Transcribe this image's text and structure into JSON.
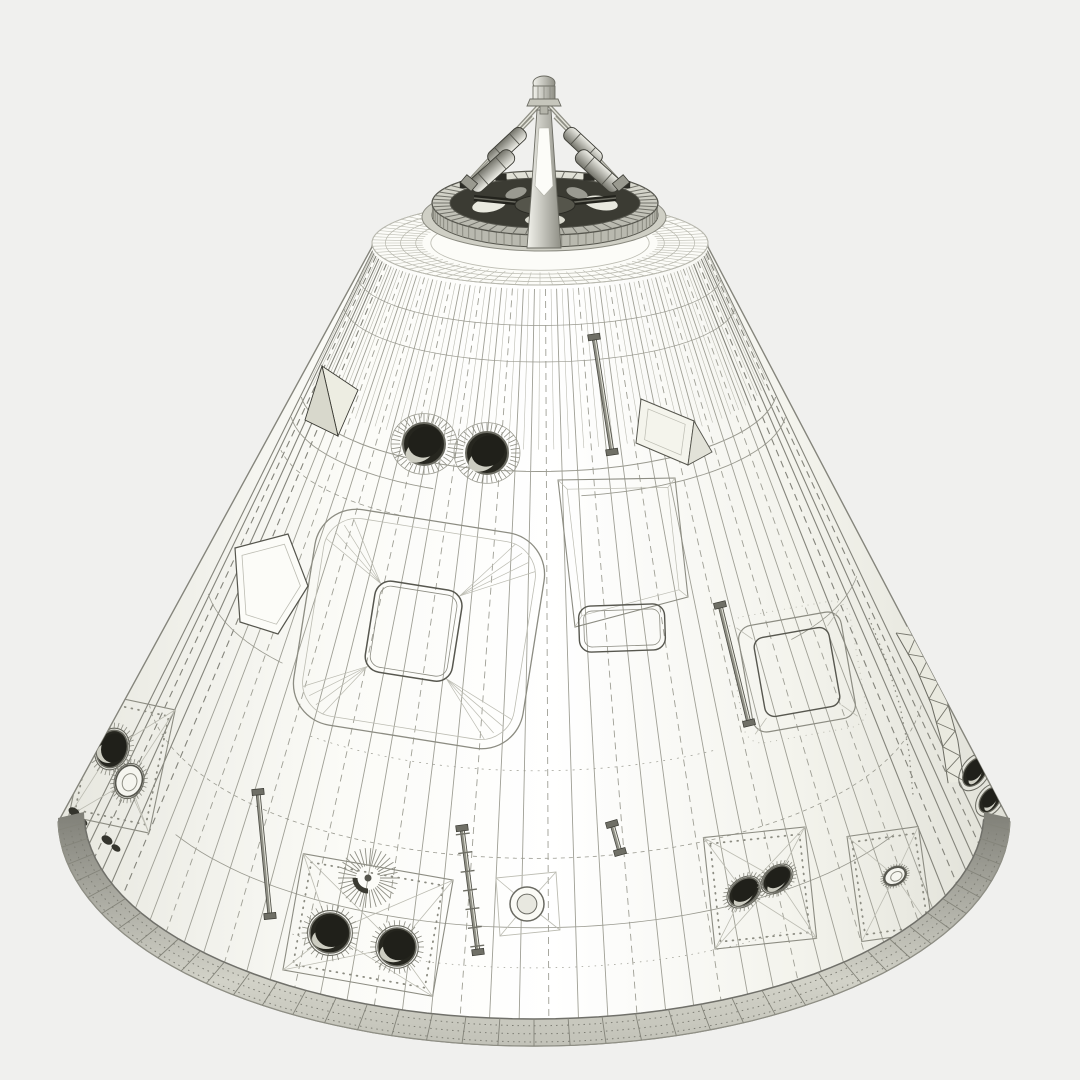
{
  "meta": {
    "alt": "Monochrome 3D wireframe render of an Apollo-style command module space capsule: truncated cone with docking probe and ring on top, crew hatch, portholes, windows, handrails, riveted RCS thruster panels and a shaded aft heat-shield rim."
  },
  "palette": {
    "background": "#f0f0ee",
    "coneEdge": "#85857c",
    "line": "#9f9f95",
    "lineDark": "#6b6b62",
    "lineFaint": "#bcbcb2",
    "ink": "#3a3a33",
    "dark": "#26261f",
    "panelStroke": "#8c8c82",
    "rivet": "#8c8c82",
    "metalDark": "#44443c",
    "ringInterior": "#3b3b33",
    "crescent": "#cdcdc2",
    "white": "#fcfcf8",
    "coneGrad": [
      "#e7e7df",
      "#fbfbf7",
      "#ffffff",
      "#f3f3ec",
      "#e0e0d7"
    ],
    "rimGrad": [
      "#7f7f77",
      "#a9a9a0",
      "#d2d2c8",
      "#c2c2b8"
    ],
    "shaftGrad": [
      "#f2f2ec",
      "#8f8f85"
    ],
    "cylGrad": [
      "#efefe8",
      "#73736a"
    ],
    "ringTopGrad": [
      "#e5e5db",
      "#b1b1a7"
    ]
  },
  "render": {
    "canvas": {
      "w": 1080,
      "h": 1080
    },
    "cone": {
      "top": {
        "cx": 540,
        "cy": 247,
        "rx": 168,
        "ry": 42
      },
      "baseOuter": {
        "cx": 534,
        "cy": 818,
        "rx": 476,
        "ry": 228
      },
      "baseInner": {
        "cx": 534,
        "cy": 812,
        "rx": 450,
        "ry": 207
      },
      "meridians": {
        "n": 46,
        "a0": 5,
        "a1": 175
      },
      "subMeridians": {
        "n": 45,
        "fEnd": 0.22
      },
      "latitudes": [
        {
          "f": 0.05,
          "a0": 5,
          "a1": 175,
          "w": 0.7
        },
        {
          "f": 0.1,
          "a0": 5,
          "a1": 175,
          "w": 0.7
        },
        {
          "f": 0.25,
          "a0": 6,
          "a1": 174,
          "w": 1.0
        },
        {
          "f": 0.285,
          "a0": 6,
          "a1": 80,
          "w": 0.9
        },
        {
          "f": 0.285,
          "a0": 115,
          "a1": 174,
          "w": 0.9
        },
        {
          "f": 0.33,
          "a0": 120,
          "a1": 170,
          "w": 0.8,
          "dash": "5 4"
        },
        {
          "f": 0.55,
          "a0": 8,
          "a1": 38,
          "w": 0.8
        },
        {
          "f": 0.58,
          "a0": 140,
          "a1": 172,
          "w": 0.8
        },
        {
          "f": 0.66,
          "a0": 60,
          "a1": 130,
          "w": 0.7,
          "dash": "2 5"
        },
        {
          "f": 0.78,
          "a0": 6,
          "a1": 174,
          "w": 0.8,
          "dash": "4 4"
        },
        {
          "f": 0.875,
          "a0": 30,
          "a1": 150,
          "w": 0.8
        },
        {
          "f": 0.93,
          "a0": 55,
          "a1": 125,
          "w": 0.7,
          "dash": "1.5 5"
        }
      ]
    },
    "dome": {
      "cx": 540,
      "cy": 243,
      "rx": 168,
      "ry": 42,
      "rings": [
        1,
        0.92,
        0.83,
        0.74,
        0.65
      ],
      "tickInner": 0.7,
      "tickN": 84
    },
    "ring": {
      "cx": 545,
      "cyTop": 203,
      "cyBot": 215,
      "rxO": 113,
      "ryO": 32,
      "rxI": 95,
      "ryI": 25,
      "teeth": 54,
      "wallTicks": 40,
      "collar": {
        "cx": 544,
        "cy": 217,
        "rx": 122,
        "ry": 34
      },
      "hub": {
        "cx": 545,
        "cy": 205,
        "rx": 30,
        "ry": 10
      },
      "spokes": [
        [
          474,
          198
        ],
        [
          616,
          198
        ],
        [
          545,
          228
        ]
      ],
      "patches": [
        {
          "cx": 489,
          "cy": 205,
          "rx": 17,
          "ry": 7,
          "rot": -10,
          "fill": "#e9e9df"
        },
        {
          "cx": 601,
          "cy": 203,
          "rx": 17,
          "ry": 7,
          "rot": 10,
          "fill": "#e9e9df"
        },
        {
          "cx": 545,
          "cy": 220,
          "rx": 20,
          "ry": 6,
          "rot": 0,
          "fill": "#dcdcd1"
        },
        {
          "cx": 516,
          "cy": 193,
          "rx": 11,
          "ry": 5,
          "rot": -18,
          "fill": "#9a9a91"
        },
        {
          "cx": 577,
          "cy": 193,
          "rx": 11,
          "ry": 5,
          "rot": 18,
          "fill": "#9a9a91"
        }
      ],
      "notchAngles": [
        -140,
        -115,
        -65,
        -40
      ]
    },
    "probe": {
      "shaft": [
        [
          537,
          110
        ],
        [
          551,
          110
        ],
        [
          557,
          196
        ],
        [
          561,
          248
        ],
        [
          527,
          248
        ],
        [
          531,
          196
        ]
      ],
      "tip": [
        [
          539,
          128
        ],
        [
          549,
          128
        ],
        [
          553,
          186
        ],
        [
          544,
          196
        ],
        [
          535,
          186
        ]
      ],
      "capDome": {
        "cx": 544,
        "cy": 83,
        "rx": 11,
        "ry": 7
      },
      "capBody": {
        "x": 533,
        "y": 86,
        "w": 22,
        "h": 13
      },
      "capFlare": [
        [
          530,
          99
        ],
        [
          558,
          99
        ],
        [
          561,
          106
        ],
        [
          527,
          106
        ]
      ],
      "neck": {
        "x": 540,
        "y": 106,
        "w": 8,
        "h": 8
      },
      "beams": [
        [
          544,
          100,
          471,
          179
        ],
        [
          544,
          100,
          617,
          179
        ],
        [
          533,
          117,
          470,
          182
        ],
        [
          555,
          117,
          618,
          182
        ]
      ],
      "cylinders": [
        {
          "cx": 507,
          "cy": 146,
          "len": 46,
          "wid": 15,
          "rot": 137
        },
        {
          "cx": 492,
          "cy": 171,
          "len": 54,
          "wid": 16,
          "rot": 138
        },
        {
          "cx": 583,
          "cy": 146,
          "len": 46,
          "wid": 15,
          "rot": 43
        },
        {
          "cx": 598,
          "cy": 171,
          "len": 54,
          "wid": 16,
          "rot": 42
        }
      ],
      "feet": [
        {
          "cx": 469,
          "cy": 183,
          "rot": 40
        },
        {
          "cx": 621,
          "cy": 183,
          "rot": -40
        }
      ]
    },
    "rim": {
      "ticks": 40,
      "midDashes": [
        0.25,
        0.55,
        0.85
      ]
    },
    "features": {
      "portholes": [
        {
          "cx": 424,
          "cy": 444,
          "r": 21,
          "ring": 33
        },
        {
          "cx": 487,
          "cy": 453,
          "r": 21,
          "ring": 33
        }
      ],
      "hatch": {
        "cx": 419,
        "cy": 629,
        "rot": 9,
        "w": 232,
        "h": 218,
        "r": 42,
        "win": {
          "dx": -5,
          "dy": 3,
          "w": 88,
          "h": 92,
          "r": 16
        }
      },
      "bay": {
        "outer": [
          [
            558,
            480
          ],
          [
            675,
            478
          ],
          [
            688,
            597
          ],
          [
            575,
            627
          ]
        ],
        "win": {
          "cx": 622,
          "cy": 628,
          "w": 86,
          "h": 46,
          "r": 12,
          "rot": -2
        }
      },
      "window2": {
        "cx": 797,
        "cy": 672,
        "rot": -10,
        "w": 104,
        "h": 108,
        "r": 14
      },
      "leftWindow": [
        [
          235,
          548
        ],
        [
          288,
          534
        ],
        [
          308,
          586
        ],
        [
          278,
          634
        ],
        [
          240,
          622
        ]
      ],
      "scoopA": [
        [
          322,
          366
        ],
        [
          358,
          390
        ],
        [
          338,
          436
        ]
      ],
      "scoopB": [
        [
          322,
          366
        ],
        [
          338,
          436
        ],
        [
          305,
          420
        ]
      ],
      "vent": {
        "box": [
          [
            641,
            399
          ],
          [
            694,
            421
          ],
          [
            688,
            465
          ],
          [
            636,
            443
          ]
        ],
        "flap": [
          [
            694,
            421
          ],
          [
            712,
            452
          ],
          [
            688,
            465
          ]
        ]
      },
      "handrails": [
        {
          "x1": 594,
          "y1": 337,
          "x2": 612,
          "y2": 452
        },
        {
          "x1": 720,
          "y1": 605,
          "x2": 749,
          "y2": 723
        },
        {
          "x1": 258,
          "y1": 792,
          "x2": 270,
          "y2": 916
        },
        {
          "x1": 612,
          "y1": 824,
          "x2": 620,
          "y2": 852
        }
      ],
      "ladder": {
        "x1": 462,
        "y1": 828,
        "x2": 478,
        "y2": 952,
        "rungs": 7
      },
      "panels": [
        {
          "cx": 122,
          "cy": 763,
          "w": 82,
          "h": 126,
          "rot": 12,
          "nozzles": [
            {
              "dx": -10,
              "dy": -14,
              "rx": 15,
              "ry": 19,
              "rot": 20
            },
            {
              "dx": 7,
              "dy": 18,
              "rx": 13,
              "ry": 16,
              "rot": 20,
              "light": true
            }
          ]
        },
        {
          "cx": 368,
          "cy": 925,
          "w": 152,
          "h": 118,
          "rot": 10,
          "nozzles": [
            {
              "dx": -38,
              "dy": 8,
              "rx": 20,
              "ry": 20,
              "rot": 0
            },
            {
              "dx": 29,
              "dy": 22,
              "rx": 19,
              "ry": 19,
              "rot": 0
            }
          ]
        },
        {
          "cx": 760,
          "cy": 888,
          "w": 102,
          "h": 112,
          "rot": -6,
          "nozzles": [
            {
              "dx": -16,
              "dy": 4,
              "rx": 17,
              "ry": 12,
              "rot": -40
            },
            {
              "dx": 17,
              "dy": -9,
              "rx": 16,
              "ry": 11,
              "rot": -40
            }
          ]
        },
        {
          "cx": 890,
          "cy": 884,
          "w": 72,
          "h": 106,
          "rot": -8,
          "nozzles": [
            {
              "dx": 5,
              "dy": -8,
              "rx": 11,
              "ry": 8,
              "rot": -30,
              "light": true
            }
          ]
        }
      ],
      "sunburst": {
        "cx": 368,
        "cy": 878,
        "r1": 12,
        "r2": 30,
        "rays": 34
      },
      "xport": {
        "cx": 527,
        "cy": 904,
        "r": 17,
        "square": [
          [
            496,
            878
          ],
          [
            556,
            872
          ],
          [
            560,
            930
          ],
          [
            500,
            936
          ]
        ]
      },
      "toothBand": {
        "pts": [
          [
            903,
            629
          ],
          [
            923,
            664
          ],
          [
            939,
            702
          ],
          [
            950,
            742
          ],
          [
            956,
            782
          ]
        ],
        "half": 8
      },
      "dashCurve": [
        [
          869,
          618
        ],
        [
          886,
          660
        ],
        [
          900,
          706
        ],
        [
          909,
          752
        ],
        [
          913,
          795
        ]
      ],
      "darkMarks": [
        {
          "cx": 74,
          "cy": 812,
          "rx": 6,
          "ry": 4,
          "rot": 35
        },
        {
          "cx": 83,
          "cy": 822,
          "rx": 5,
          "ry": 3,
          "rot": 35
        },
        {
          "cx": 107,
          "cy": 840,
          "rx": 6,
          "ry": 4,
          "rot": 35
        },
        {
          "cx": 116,
          "cy": 848,
          "rx": 5,
          "ry": 3,
          "rot": 35
        }
      ],
      "edgeOvals": [
        {
          "cx": 975,
          "cy": 772,
          "rx": 16,
          "ry": 10,
          "rot": -55
        },
        {
          "cx": 990,
          "cy": 800,
          "rx": 14,
          "ry": 9,
          "rot": -55
        }
      ]
    }
  }
}
